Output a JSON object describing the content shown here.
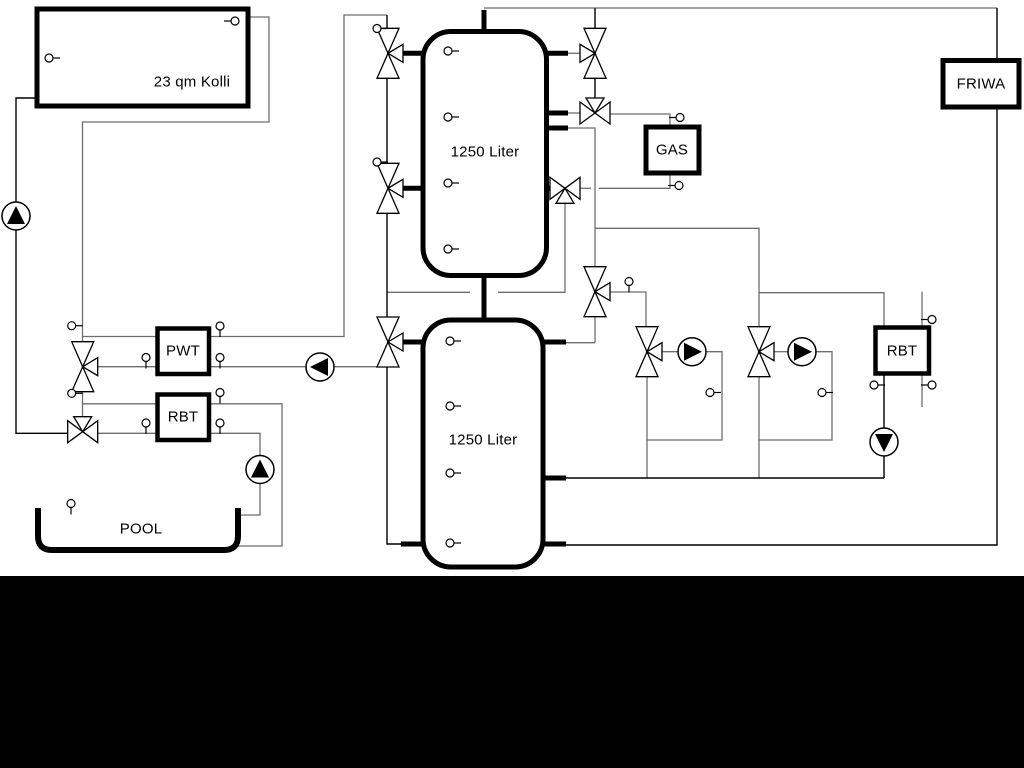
{
  "diagram": {
    "type": "heating-system-schematic",
    "labels": {
      "collector": "23 qm Kolli",
      "tank_top": "1250 Liter",
      "tank_bottom": "1250 Liter",
      "gas_boiler": "GAS",
      "friwa_station": "FRIWA",
      "pwt_exchanger": "PWT",
      "rbt_left": "RBT",
      "rbt_right": "RBT",
      "pool": "POOL"
    },
    "colors": {
      "background": "#ffffff",
      "pipe_gray": "#6e6e6e",
      "line_black": "#000000",
      "footer_band": "#000000",
      "component_fill": "#ffffff"
    }
  }
}
